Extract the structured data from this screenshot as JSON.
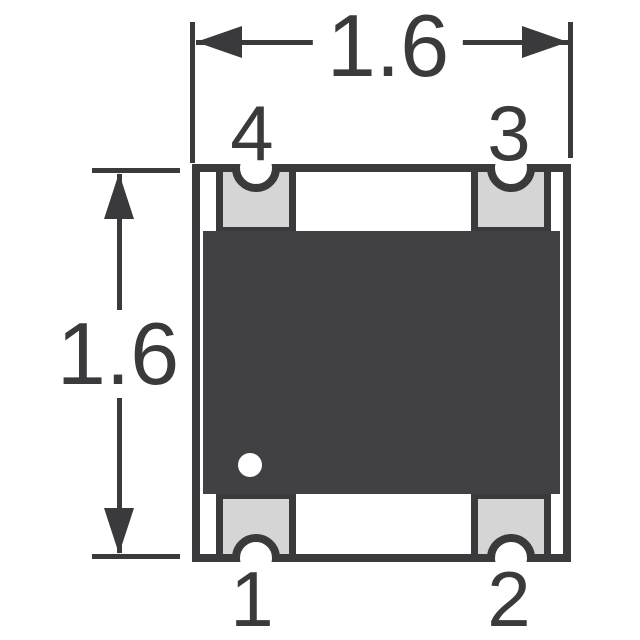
{
  "drawing_type": "component-package-dimension-drawing",
  "dimensions": {
    "width": {
      "label": "1.6"
    },
    "height": {
      "label": "1.6"
    }
  },
  "pins": {
    "top_left": {
      "number": "4"
    },
    "top_right": {
      "number": "3"
    },
    "bottom_left": {
      "number": "1"
    },
    "bottom_right": {
      "number": "2"
    }
  },
  "markers": {
    "pin1_indicator": "white-dot"
  },
  "colors": {
    "ink": "#3a3a3c",
    "body": "#414144",
    "pad": "#d5d5d6",
    "bg": "#ffffff"
  }
}
